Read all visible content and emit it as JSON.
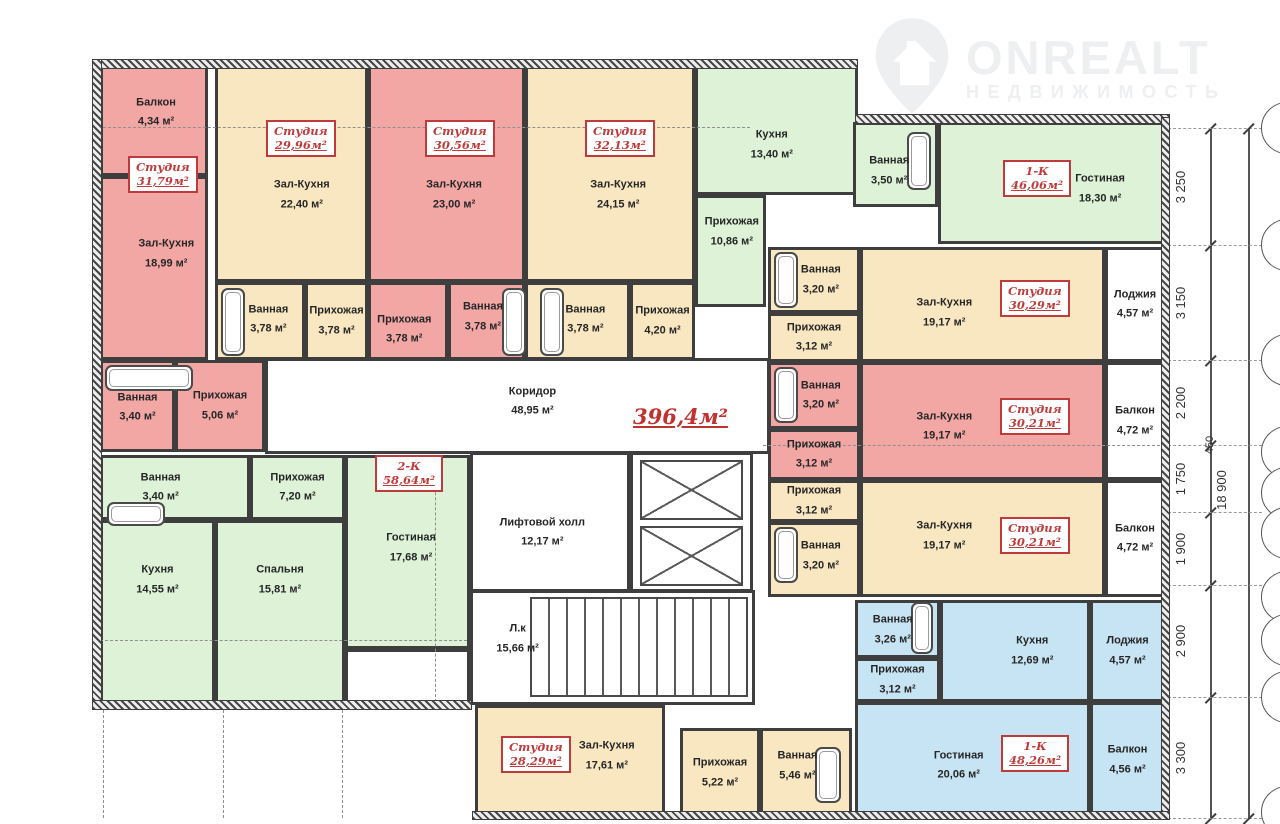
{
  "watermark": {
    "brand": "ONREALT",
    "subtitle": "НЕДВИЖИМОСТЬ",
    "icon": "house-pin-icon"
  },
  "colors": {
    "pink": "#f2a7a5",
    "tan": "#f9e7c2",
    "green": "#ddf2d7",
    "blue": "#c7e4f4",
    "white": "#ffffff",
    "wall": "#3e3e3e",
    "accent_red": "#bf3a3a",
    "dash": "#8f8f8f"
  },
  "plan": {
    "total_area": "396,4м²",
    "total_area_pos": [
      538,
      342
    ],
    "rooms": [
      [
        "a1-balcony",
        "Балкон",
        "4,34 м²",
        "pink",
        5,
        4,
        108,
        110,
        52,
        42
      ],
      [
        "a1-hall-kitchen",
        "Зал-Кухня",
        "18,99 м²",
        "pink",
        5,
        114,
        108,
        184,
        62,
        42
      ],
      [
        "a1-bath",
        "Ванная",
        "3,40 м²",
        "pink",
        5,
        298,
        75,
        92,
        50,
        52
      ],
      [
        "a1-entry",
        "Прихожая",
        "5,06 м²",
        "pink",
        80,
        298,
        90,
        92,
        null,
        null
      ],
      [
        "a2-hall-kitchen",
        "Зал-Кухня",
        "22,40 м²",
        "tan",
        120,
        4,
        153,
        216,
        57,
        60
      ],
      [
        "a2-bath",
        "Ванная",
        "3,78 м²",
        "tan",
        120,
        220,
        90,
        78,
        60,
        48
      ],
      [
        "a2-entry",
        "Прихожая",
        "3,78 м²",
        "tan",
        210,
        220,
        63,
        78,
        null,
        null
      ],
      [
        "a3-hall-kitchen",
        "Зал-Кухня",
        "23,00 м²",
        "pink",
        273,
        4,
        157,
        216,
        55,
        60
      ],
      [
        "a3-entry",
        "Прихожая",
        "3,78 м²",
        "pink",
        273,
        220,
        80,
        78,
        45,
        62
      ],
      [
        "a3-bath",
        "Ванная",
        "3,78 м²",
        "pink",
        353,
        220,
        77,
        78,
        45,
        45
      ],
      [
        "a4-hall-kitchen",
        "Зал-Кухня",
        "24,15 м²",
        "tan",
        430,
        4,
        170,
        216,
        55,
        60
      ],
      [
        "a4-bath",
        "Ванная",
        "3,78 м²",
        "tan",
        430,
        220,
        105,
        78,
        58,
        48
      ],
      [
        "a4-entry",
        "Прихожая",
        "4,20 м²",
        "tan",
        535,
        220,
        65,
        78,
        null,
        null
      ],
      [
        "a5-kitchen",
        "Кухня",
        "13,40 м²",
        "green",
        600,
        4,
        163,
        129,
        47,
        62
      ],
      [
        "a5-entry",
        "Прихожая",
        "10,86 м²",
        "green",
        600,
        133,
        71,
        112,
        52,
        32
      ],
      [
        "a5-bath",
        "Ванная",
        "3,50 м²",
        "green",
        758,
        60,
        85,
        85,
        42,
        58
      ],
      [
        "a5-living",
        "Гостиная",
        "18,30 м²",
        "green",
        843,
        60,
        227,
        122,
        72,
        55
      ],
      [
        "b1-bath",
        "Ванная",
        "3,20 м²",
        "tan",
        673,
        185,
        92,
        66,
        58,
        50
      ],
      [
        "b1-entry",
        "Прихожая",
        "3,12 м²",
        "tan",
        673,
        251,
        92,
        49,
        null,
        null
      ],
      [
        "b1-hall-kitchen",
        "Зал-Кухня",
        "19,17 м²",
        "tan",
        765,
        185,
        245,
        115,
        34,
        58
      ],
      [
        "b1-loggia",
        "Лоджия",
        "4,57 м²",
        "white",
        1010,
        185,
        60,
        115,
        null,
        null
      ],
      [
        "b2-bath",
        "Ванная",
        "3,20 м²",
        "pink",
        673,
        300,
        92,
        67,
        58,
        50
      ],
      [
        "b2-entry",
        "Прихожая",
        "3,12 м²",
        "pink",
        673,
        367,
        92,
        51,
        null,
        null
      ],
      [
        "b2-hall-kitchen",
        "Зал-Кухня",
        "19,17 м²",
        "pink",
        765,
        300,
        245,
        118,
        34,
        55
      ],
      [
        "b2-balcony",
        "Балкон",
        "4,72 м²",
        "white",
        1010,
        300,
        60,
        118,
        null,
        null
      ],
      [
        "b3-entry",
        "Прихожая",
        "3,12 м²",
        "tan",
        673,
        418,
        92,
        42,
        null,
        null
      ],
      [
        "b3-bath",
        "Ванная",
        "3,20 м²",
        "tan",
        673,
        460,
        92,
        75,
        58,
        45
      ],
      [
        "b3-hall-kitchen",
        "Зал-Кухня",
        "19,17 м²",
        "tan",
        765,
        418,
        245,
        117,
        34,
        48
      ],
      [
        "b3-balcony",
        "Балкон",
        "4,72 м²",
        "white",
        1010,
        418,
        60,
        117,
        null,
        null
      ],
      [
        "b4-bath",
        "Ванная",
        "3,26 м²",
        "blue",
        760,
        538,
        85,
        58,
        44,
        52
      ],
      [
        "b4-entry",
        "Прихожая",
        "3,12 м²",
        "blue",
        760,
        596,
        85,
        44,
        null,
        null
      ],
      [
        "b4-kitchen",
        "Кухня",
        "12,69 м²",
        "blue",
        845,
        538,
        150,
        102,
        62,
        50
      ],
      [
        "b4-loggia",
        "Лоджия",
        "4,57 м²",
        "blue",
        995,
        538,
        75,
        102,
        null,
        null
      ],
      [
        "b4-living",
        "Гостиная",
        "20,06 м²",
        "blue",
        760,
        640,
        235,
        116,
        44,
        55
      ],
      [
        "b4-balcony",
        "Балкон",
        "4,56 м²",
        "blue",
        995,
        640,
        75,
        116,
        null,
        null
      ],
      [
        "c1-bath",
        "Ванная",
        "3,40 м²",
        "green",
        5,
        393,
        150,
        65,
        40,
        50
      ],
      [
        "c1-entry",
        "Прихожая",
        "7,20 м²",
        "green",
        155,
        393,
        95,
        65,
        null,
        null
      ],
      [
        "c1-living",
        "Гостиная",
        "17,68 м²",
        "green",
        250,
        393,
        125,
        194,
        53,
        48
      ],
      [
        "c1-kitchen",
        "Кухня",
        "14,55 м²",
        "green",
        5,
        458,
        115,
        185,
        50,
        32
      ],
      [
        "c1-bedroom",
        "Спальня",
        "15,81 м²",
        "green",
        120,
        458,
        130,
        185,
        50,
        32
      ],
      [
        "c1-loggia",
        "",
        "",
        "white",
        250,
        587,
        125,
        55,
        null,
        null
      ],
      [
        "corridor",
        "Коридор",
        "48,95 м²",
        "white",
        170,
        296,
        505,
        96,
        53,
        45
      ],
      [
        "lift-hall",
        "Лифтовой холл",
        "12,17 м²",
        "white",
        375,
        390,
        160,
        140,
        45,
        58
      ],
      [
        "stairwell",
        "Л.к",
        "15,66 м²",
        "white",
        375,
        528,
        285,
        115,
        16,
        42
      ],
      [
        "d1-hall-kitchen",
        "Зал-Кухня",
        "17,61 м²",
        "tan",
        380,
        643,
        190,
        113,
        70,
        45
      ],
      [
        "d1-entry",
        "Прихожая",
        "5,22 м²",
        "tan",
        585,
        666,
        80,
        90,
        null,
        null
      ],
      [
        "d1-bath",
        "Ванная",
        "5,46 м²",
        "tan",
        665,
        666,
        92,
        90,
        40,
        42
      ]
    ],
    "unit_tags": [
      [
        "Студия",
        "31,79м²",
        33,
        94
      ],
      [
        "Студия",
        "29,96м²",
        171,
        58
      ],
      [
        "Студия",
        "30,56м²",
        330,
        58
      ],
      [
        "Студия",
        "32,13м²",
        490,
        58
      ],
      [
        "1-К",
        "46,06м²",
        908,
        98
      ],
      [
        "Студия",
        "30,29м²",
        905,
        218
      ],
      [
        "Студия",
        "30,21м²",
        905,
        336
      ],
      [
        "Студия",
        "30,21м²",
        905,
        455
      ],
      [
        "1-К",
        "48,26м²",
        906,
        673
      ],
      [
        "2-К",
        "58,64м²",
        280,
        393
      ],
      [
        "Студия",
        "28,29м²",
        406,
        674
      ]
    ],
    "tubs": [
      [
        10,
        303,
        88,
        26
      ],
      [
        126,
        226,
        24,
        68
      ],
      [
        407,
        226,
        24,
        68
      ],
      [
        445,
        226,
        24,
        68
      ],
      [
        812,
        70,
        24,
        58
      ],
      [
        679,
        190,
        24,
        56
      ],
      [
        679,
        305,
        24,
        56
      ],
      [
        679,
        465,
        24,
        56
      ],
      [
        816,
        540,
        22,
        52
      ],
      [
        720,
        685,
        26,
        56
      ],
      [
        12,
        440,
        58,
        24
      ]
    ],
    "core_box": [
      535,
      390,
      123,
      140
    ],
    "elevators": [
      [
        545,
        398,
        103,
        60
      ],
      [
        545,
        464,
        103,
        60
      ]
    ],
    "stairs_box": [
      435,
      535,
      218,
      100
    ],
    "axis_h": [
      [
        65,
        8,
        655
      ],
      [
        578,
        5,
        372
      ],
      [
        383,
        668,
        1070
      ]
    ],
    "axis_v": [
      [
        340,
        395,
        640
      ],
      [
        8,
        648,
        756
      ],
      [
        128,
        648,
        756
      ],
      [
        247,
        648,
        756
      ]
    ],
    "hatch_strips": [
      [
        -3,
        -3,
        766,
        10
      ],
      [
        760,
        52,
        315,
        10
      ],
      [
        1066,
        55,
        9,
        703
      ],
      [
        -3,
        -3,
        10,
        649
      ],
      [
        -3,
        638,
        380,
        10
      ],
      [
        377,
        749,
        698,
        9
      ]
    ]
  },
  "dimensions": {
    "boundaries_y": [
      128,
      245,
      360,
      445,
      512,
      585,
      697,
      818
    ],
    "segments": [
      "3 250",
      "3 150",
      "2 200",
      "1 750",
      "1 900",
      "2 900",
      "3 300"
    ],
    "segment_line_x": 1210,
    "total_line_x": 1248,
    "total_label": "18 900",
    "total_label_pos": [
      1223,
      490
    ],
    "note_label": "450",
    "note_pos": [
      1213,
      445
    ],
    "bubbles_cx": 1287,
    "bubbles": [
      [
        128,
        ""
      ],
      [
        245,
        "Х"
      ],
      [
        360,
        ""
      ],
      [
        452,
        ""
      ],
      [
        493,
        "П"
      ],
      [
        533,
        "П"
      ],
      [
        597,
        ""
      ],
      [
        640,
        ""
      ],
      [
        697,
        ""
      ],
      [
        812,
        ""
      ]
    ]
  }
}
